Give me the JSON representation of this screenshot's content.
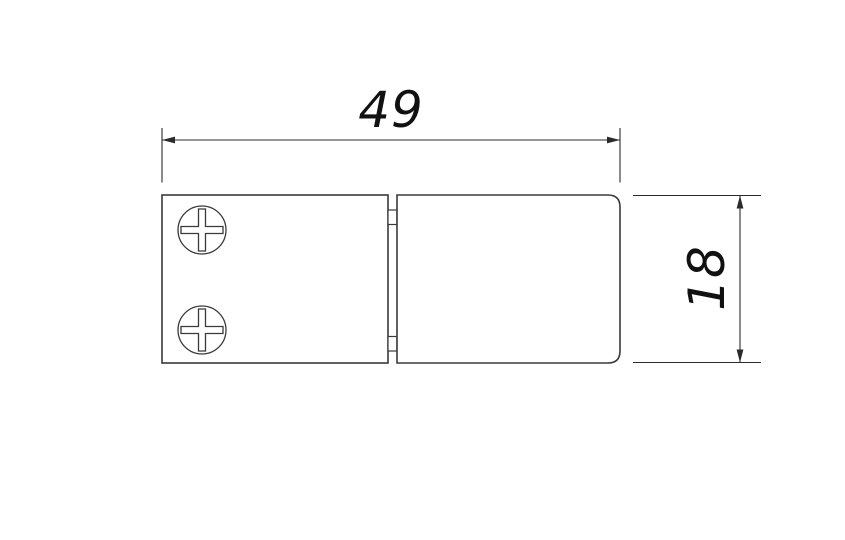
{
  "page": {
    "background_color": "#ffffff"
  },
  "drawing": {
    "kind": "technical-dimension-drawing",
    "stroke_color": "#3a3a3a",
    "dimension_line_color": "#2b2b2b",
    "text_color": "#111111",
    "dimensions": {
      "width": {
        "value": "49"
      },
      "height": {
        "value": "18"
      }
    },
    "icons": {
      "screw_top": "phillips-screw-icon",
      "screw_bottom": "phillips-screw-icon"
    }
  }
}
